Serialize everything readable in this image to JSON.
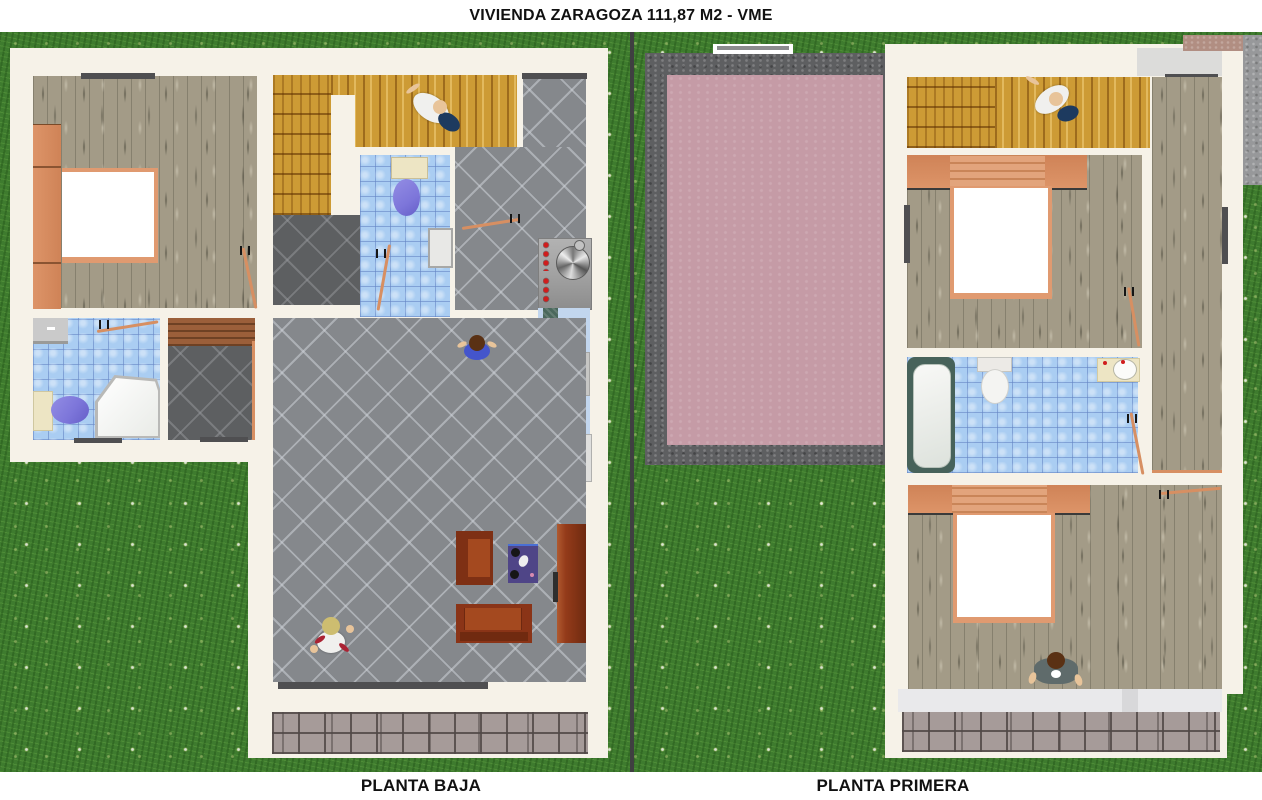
{
  "header": {
    "title": "VIVIENDA ZARAGOZA  111,87 M2 - VME"
  },
  "footer": {
    "left_label": "PLANTA BAJA",
    "right_label": "PLANTA PRIMERA"
  },
  "palette": {
    "grass": "#3e7b2e",
    "paper": "#f6f2e8",
    "divider": "#3f3f41",
    "window": "#4f4f51",
    "wood_gray": "#a39b87",
    "wood_gold": "#cd9b35",
    "wood_brown": "#9b5f3a",
    "tile_mid": "#85888c",
    "tile_dark": "#5d5f61",
    "tile_blue": "#aacdf2",
    "orange": "#dd9468",
    "door": "#d78f62",
    "bedframe": "#e09a70",
    "roof_pink": "#c59ba6",
    "gravel": "#5e5f61",
    "paving": "#a69b99",
    "terrace_pink": "#b18e82",
    "stone_gray": "#97989a",
    "balcony": "#e9e9eb",
    "sofa": "#8a3417",
    "armchair": "#7e3014",
    "seat": "#a4491f",
    "desk": "#943b1a",
    "rug": "#4f4587",
    "toilet_purple": "#7d76da",
    "cream": "#ede5c4",
    "appliance": "#dfdfdd",
    "counter_blue": "#c2d6ee",
    "counter_teal": "#4a685c",
    "stove": "#a2a2a2",
    "knob_red": "#d01d1d",
    "tub_edge": "#47625a",
    "skin": "#e8c49a",
    "hair_blonde": "#cdbd70",
    "hair_brown": "#5a3114",
    "shirt_white": "#f0f0ee",
    "shirt_blue": "#4455cc",
    "jacket_gray": "#5f6b6b",
    "pants_navy": "#1d3a5f"
  }
}
